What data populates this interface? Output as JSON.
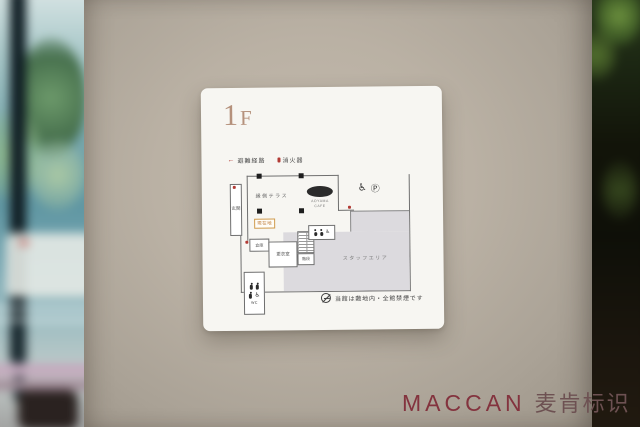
{
  "watermark": {
    "brand": "MACCAN",
    "brand_cn": "麦肯标识"
  },
  "sign": {
    "floor": {
      "number": "1",
      "suffix": "F"
    },
    "legend": {
      "evacuation": {
        "symbol": "←",
        "label": "避難経路"
      },
      "extinguisher": {
        "label": "消火器"
      }
    },
    "map": {
      "entrance": "玄関",
      "terrace": "縁側テラス",
      "cafe": {
        "line1": "AOYAMA",
        "line2": "CAFE"
      },
      "you_are_here": "現在地",
      "storage": "倉庫",
      "changing_room": "更衣室",
      "stairs": "階段",
      "staff_area": "スタッフエリア",
      "wc": "WC",
      "icons": {
        "wheelchair": "♿",
        "parking": "Ⓟ"
      }
    },
    "notice": "当館は敷地内・全館禁煙です"
  },
  "colors": {
    "floor_title": "#b5917c",
    "marker_red": "#b23b35",
    "sign_background": "#f7f6f2",
    "wall": "#b3aa9e",
    "staff_area_fill": "#dcdade",
    "watermark_maroon": "#83333e"
  }
}
